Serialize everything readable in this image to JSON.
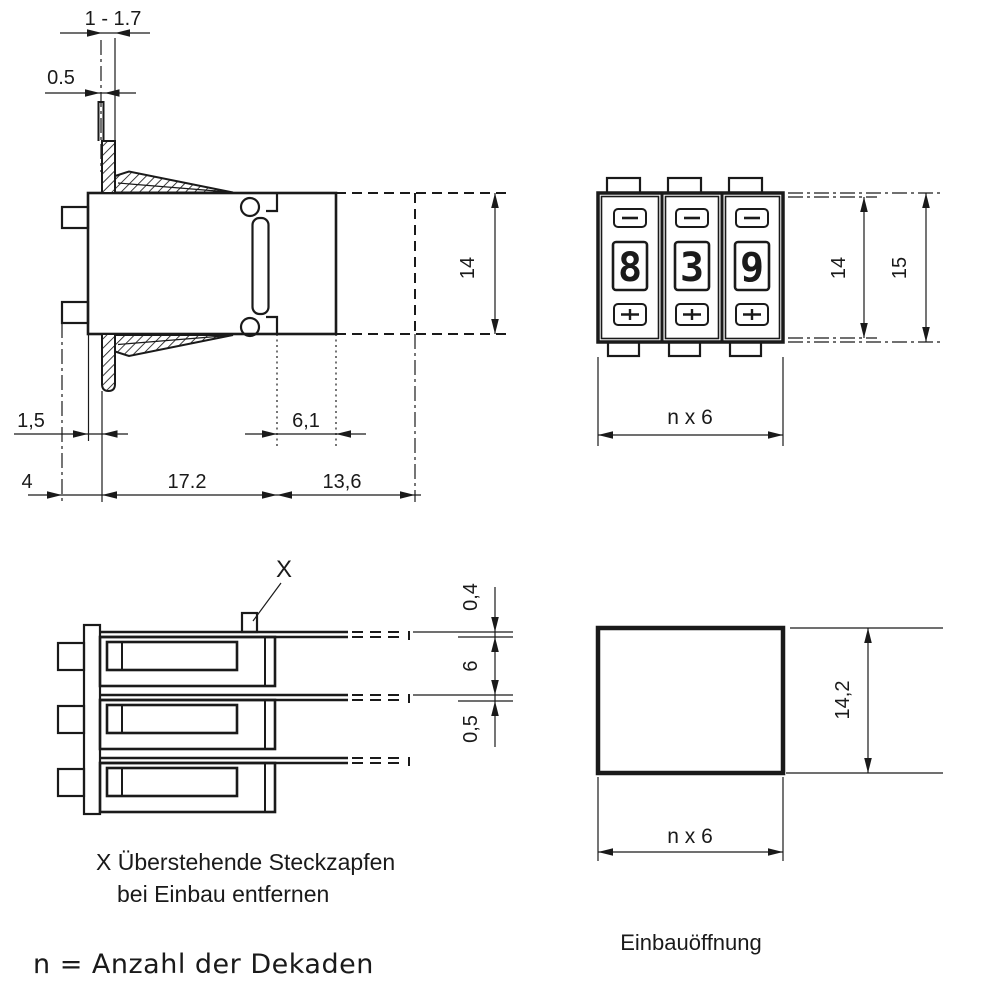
{
  "side_view": {
    "dim_panel_thickness_range": "1 - 1.7",
    "dim_pin_protrusion": "0.5",
    "dim_front_offset": "1,5",
    "dim_slot_depth": "6,1",
    "dim_pin_length": "4",
    "dim_body_depth": "17.2",
    "dim_rear_depth": "13,6",
    "dim_height": "14"
  },
  "front_view": {
    "digits": [
      "8",
      "3",
      "9"
    ],
    "dim_inner_height": "14",
    "dim_outer_height": "15",
    "dim_width": "n x 6"
  },
  "top_view": {
    "marker": "X",
    "dim_pin_thickness": "0,4",
    "dim_decade_pitch": "6",
    "dim_plate_thickness": "0,5"
  },
  "opening_view": {
    "caption": "Einbauöffnung",
    "dim_height": "14,2",
    "dim_width": "n x 6"
  },
  "notes": {
    "x_note_line1": "X Überstehende Steckzapfen",
    "x_note_line2": "bei Einbau entfernen",
    "n_note": "n = Anzahl der Dekaden"
  },
  "colors": {
    "ink": "#1a1a1a",
    "paper": "#ffffff"
  }
}
